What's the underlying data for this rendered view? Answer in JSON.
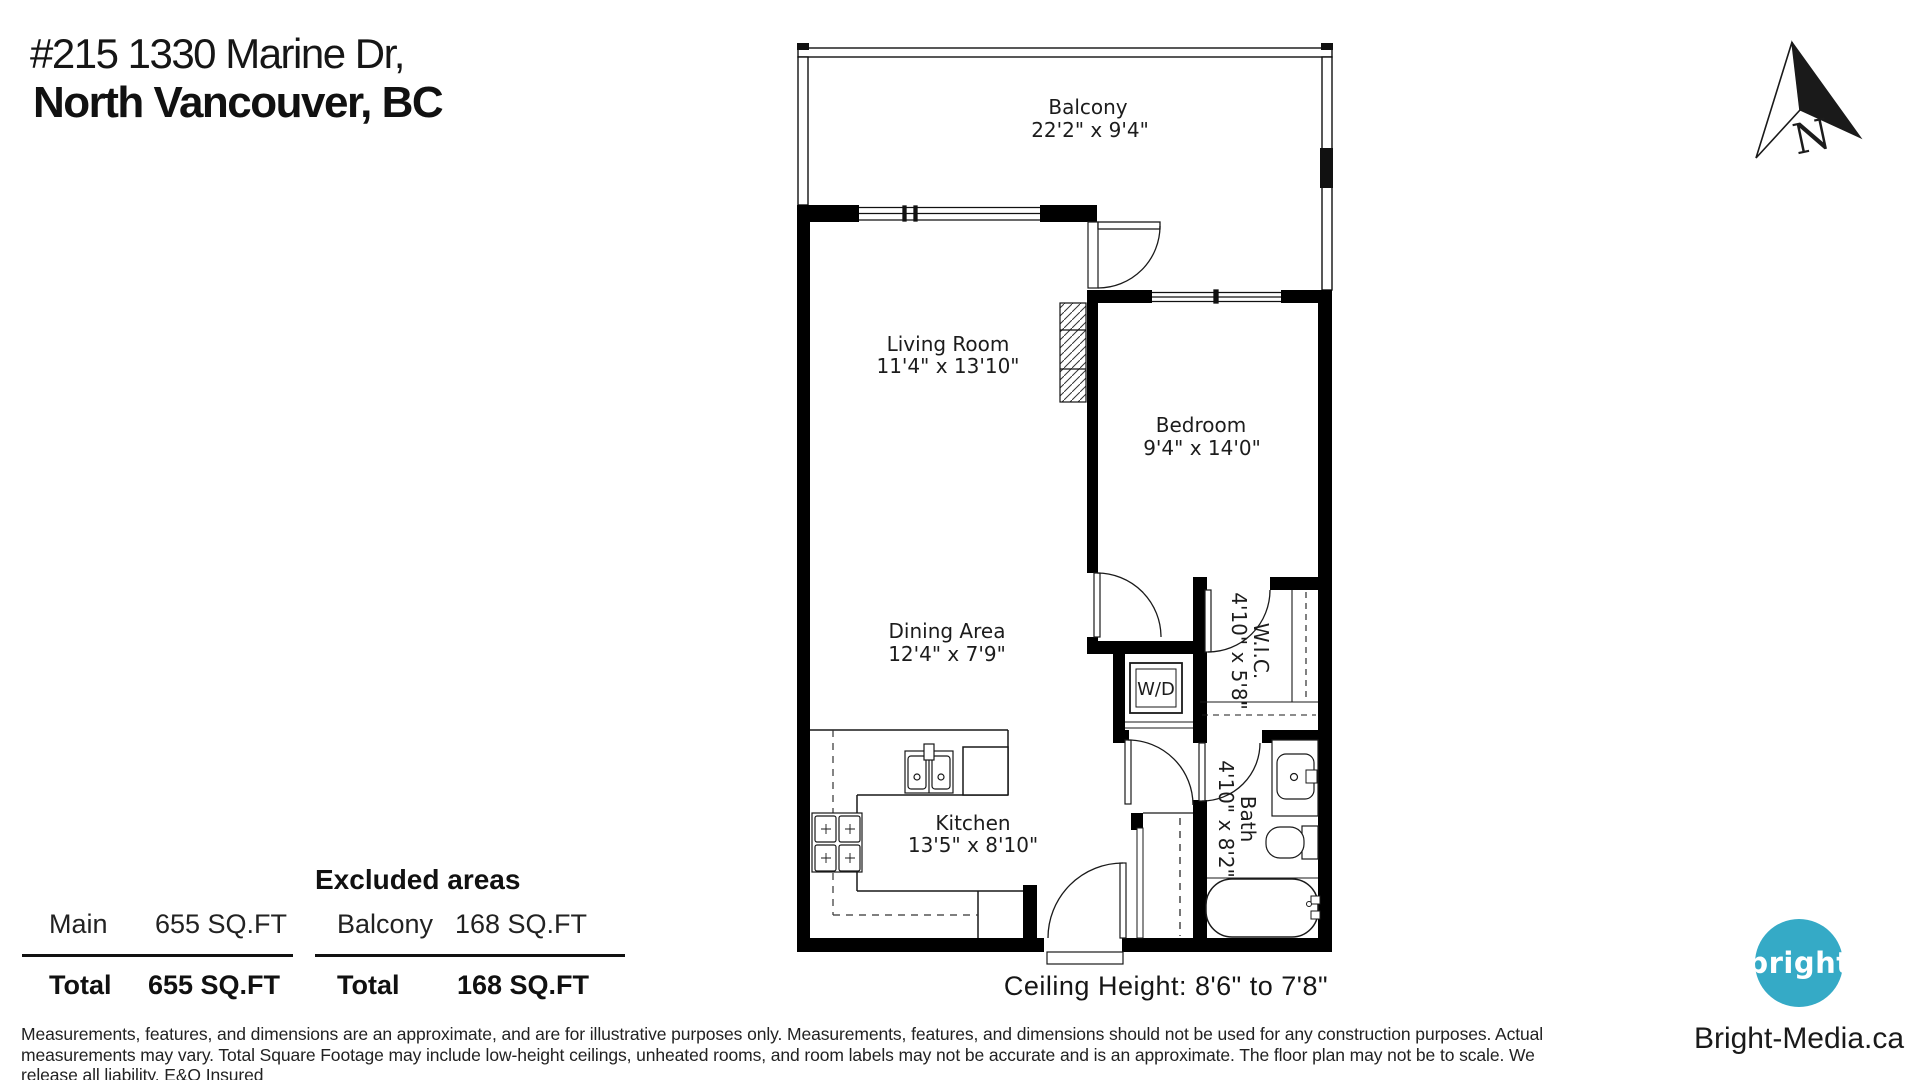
{
  "header": {
    "address_line1": "#215 1330 Marine Dr,",
    "address_line2": "North Vancouver, BC"
  },
  "compass": {
    "label": "N"
  },
  "floorplan": {
    "rooms": {
      "balcony": {
        "name": "Balcony",
        "dims": "22'2\" x 9'4\""
      },
      "living": {
        "name": "Living Room",
        "dims": "11'4\" x 13'10\""
      },
      "bedroom": {
        "name": "Bedroom",
        "dims": "9'4\" x 14'0\""
      },
      "dining": {
        "name": "Dining Area",
        "dims": "12'4\" x 7'9\""
      },
      "kitchen": {
        "name": "Kitchen",
        "dims": "13'5\" x 8'10\""
      },
      "wic": {
        "name": "W.I.C.",
        "dims": "4'10\" x 5'8\""
      },
      "bath": {
        "name": "Bath",
        "dims": "4'10\" x 8'2\""
      },
      "wd": {
        "name": "W/D"
      }
    },
    "ceiling_note": "Ceiling Height: 8'6\" to 7'8\""
  },
  "tables": {
    "main": {
      "rows": [
        {
          "label": "Main",
          "value": "655 SQ.FT"
        }
      ],
      "total_label": "Total",
      "total_value": "655 SQ.FT"
    },
    "excluded": {
      "title": "Excluded areas",
      "rows": [
        {
          "label": "Balcony",
          "value": "168 SQ.FT"
        }
      ],
      "total_label": "Total",
      "total_value": "168 SQ.FT"
    }
  },
  "disclaimer": {
    "line1": "Measurements, features, and dimensions are an approximate, and are for illustrative purposes only. Measurements, features, and dimensions should not be used for any construction purposes. Actual",
    "line2": "measurements may vary. Total Square Footage may include low-height ceilings, unheated rooms, and room labels may not be accurate and is an approximate. The floor plan may not be to scale. We",
    "line3": "release all liability. E&O Insured"
  },
  "branding": {
    "logo_text": "bright",
    "website": "Bright-Media.ca",
    "logo_color": "#35aac6"
  }
}
